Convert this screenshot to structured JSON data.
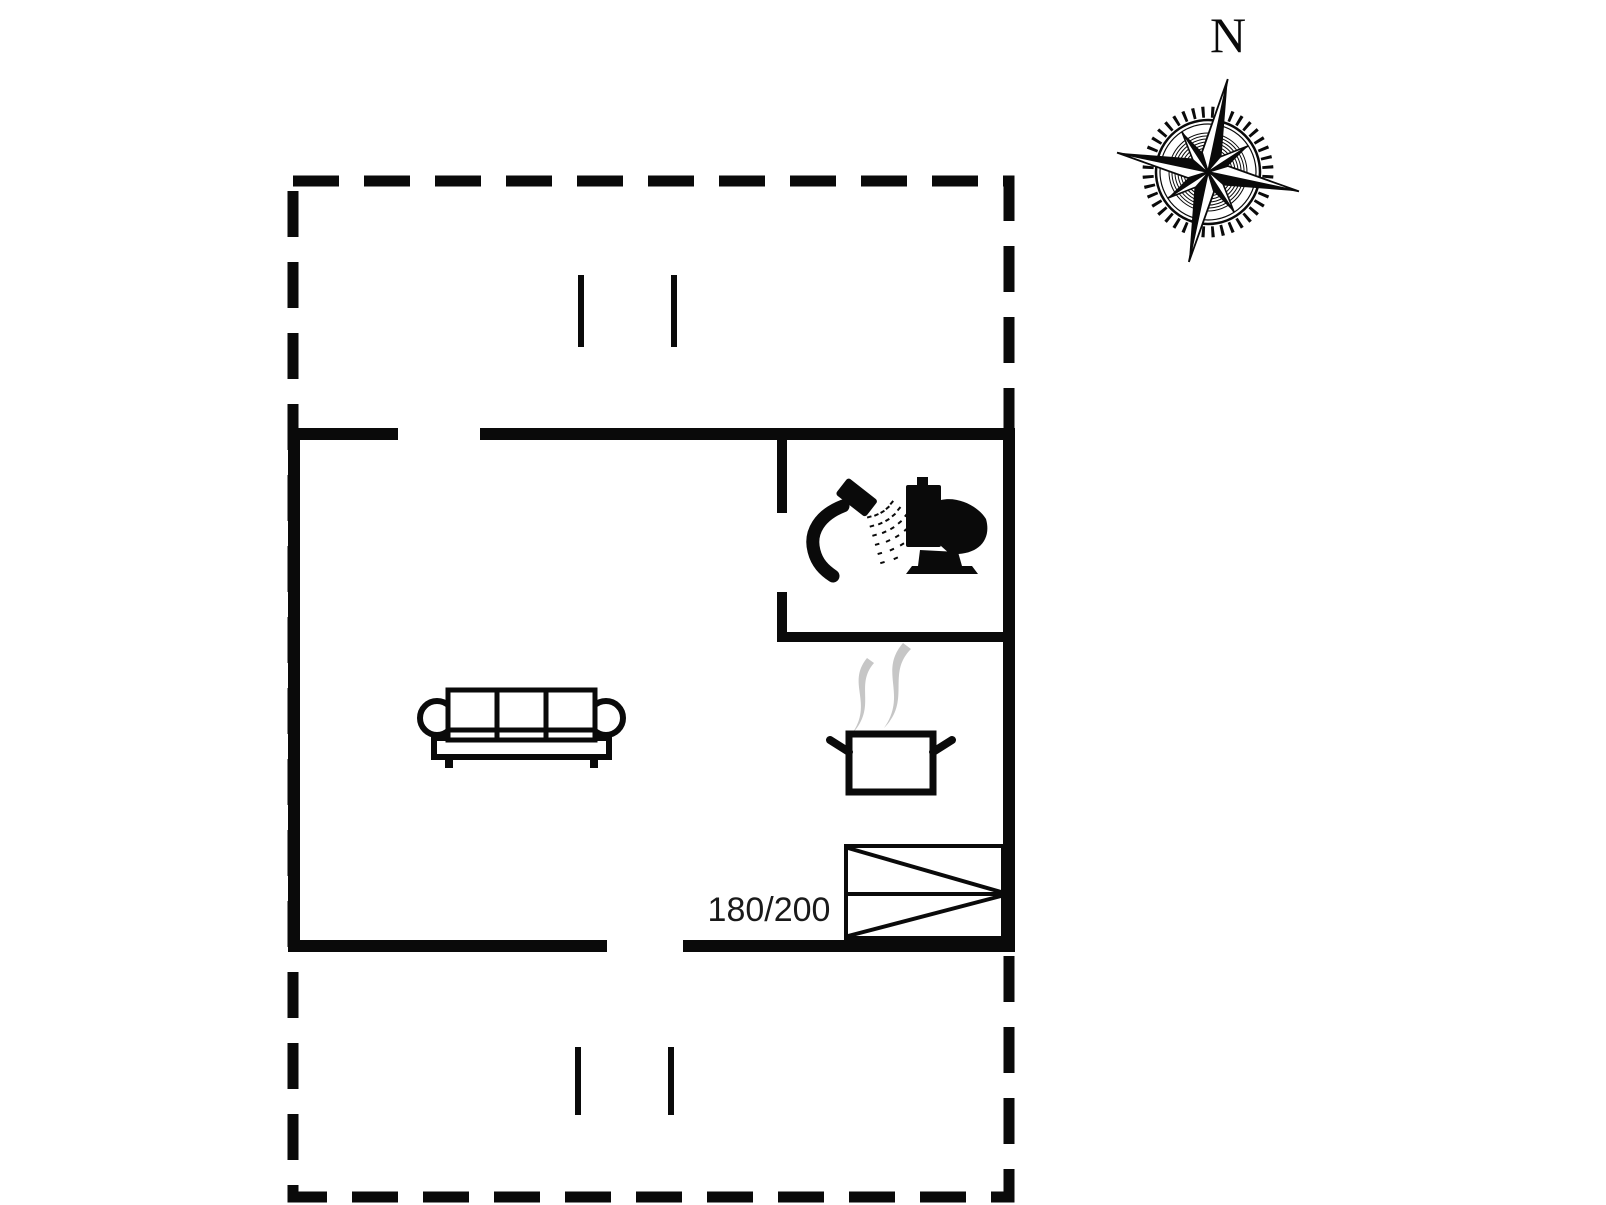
{
  "colors": {
    "ink": "#0a0a0a",
    "steam": "#c6c6c6",
    "background": "#ffffff"
  },
  "compass": {
    "label": "N",
    "icon": "compass-rose-icon"
  },
  "bed": {
    "size_label": "180/200",
    "icon": "double-bed-icon"
  },
  "icons": {
    "shower": "shower-icon",
    "toilet": "toilet-icon",
    "sofa": "sofa-icon",
    "pot": "cooking-pot-icon",
    "steam": "steam-icon",
    "bed": "double-bed-icon",
    "compass": "compass-rose-icon"
  }
}
